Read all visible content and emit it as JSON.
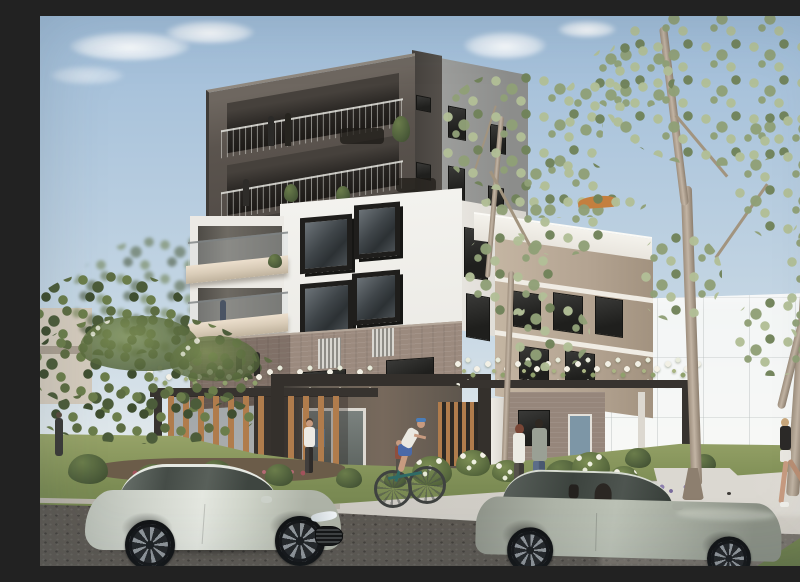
{
  "scene": {
    "type": "architectural-render",
    "description": "Daytime architectural render of a modern six-storey apartment building with a dark charcoal top volume containing two recessed balcony levels, a white mid-section with black box-framed windows, a taupe brick base with louvred screens, and a timber-and-steel entry pergola covered in white flowering vines; eucalyptus trees frame the scene, translucent white massing volumes indicate neighbouring future development, and the street in front has a parked silver sedan, a passing grey sedan, a cyclist, walkers and two joggers.",
    "sky": {
      "condition": "clear light-blue sky with small soft white clouds"
    },
    "building": {
      "storeys_visible": 6,
      "top_levels": "dark charcoal box, two recessed balcony levels with thin metal railings, residents and potted plants on balconies",
      "right_tower": "grey vertically-clad corner with small dark window slots",
      "middle_levels": "white facade, two rows of protruding black box-framed windows, beige balcony slabs with glass balustrades on the left",
      "lower_levels": "taupe face-brick band with vertical louvre screens and dark windows",
      "roof_terrace": "planted rooftop terrace with a rust-orange umbrella on the right wing",
      "ground_level": "charcoal base with timber batten screens, glazed lobby entry and brick wing"
    },
    "landscape": {
      "pergola": "dark steel portal frames with vertical timber battens and white climbing flowers",
      "gardens": "clipped round bushes, white rose beds, red and purple flower borders, lawn verge",
      "trees": "tall eucalyptus trees on the right and centre, dense leafy green and white-flowering trees on the left",
      "future_development": "translucent white gridded massing volumes behind the trees",
      "street": "dark asphalt road, light concrete footpath and driveway, grass nature strip"
    },
    "vehicles": [
      {
        "type": "sedan",
        "color": "silver",
        "state": "parked, facing right, foreground left"
      },
      {
        "type": "sedan",
        "color": "grey-green",
        "state": "moving right with driver visible, foreground right"
      }
    ],
    "people": [
      {
        "where": "upper balcony",
        "what": "two residents standing at the railing"
      },
      {
        "where": "lower balcony",
        "what": "resident among potted plants"
      },
      {
        "where": "mid-level balcony",
        "what": "resident at the balustrade"
      },
      {
        "where": "level-one balcony behind flowers",
        "what": "two residents"
      },
      {
        "where": "entry path",
        "what": "woman in white top walking"
      },
      {
        "where": "garden path",
        "what": "child in dark red top"
      },
      {
        "where": "street verge",
        "what": "cyclist in white tee, blue cap and blue shorts"
      },
      {
        "where": "footpath centre",
        "what": "couple strolling"
      },
      {
        "where": "footpath right",
        "what": "two women jogging past eucalyptus trunks"
      },
      {
        "where": "far-left garden",
        "what": "pedestrian in dark clothing"
      }
    ]
  },
  "colors": {
    "sky_top": "#9fbcd8",
    "sky_mid": "#c6d7e4",
    "sky_low": "#e4eaec",
    "charcoal": "#5b544e",
    "charcoal_dark": "#353029",
    "charcoal_deep": "#1d1a17",
    "grey_clad": "#9d9e9c",
    "white_wall": "#f3f2ee",
    "white_shade": "#dedbd4",
    "window_black": "#23221f",
    "glass_dark": "#3f4549",
    "glass_mid": "#6c7378",
    "balcony_beige": "#d9ccb8",
    "brick": "#9b8a7e",
    "tan_wing": "#c4b5a2",
    "timber": "#b07c4c",
    "steel_dark": "#37332f",
    "euc_light": "#b2bf97",
    "euc_mid": "#90a077",
    "euc_dark": "#71835a",
    "foliage_dark": "#4c5c3a",
    "foliage_mid": "#6b7d4b",
    "trunk_light": "#c2b4a4",
    "trunk_mid": "#9d8e7d",
    "grass_light": "#97a368",
    "grass_mid": "#7c8c54",
    "grass_dark": "#67784a",
    "soil": "#6b5c49",
    "road": "#5d5953",
    "path": "#d5d2cb",
    "driveway": "#dbd8d1",
    "curb": "#b7b2a8",
    "car_silver": "#d6dad2",
    "car_grey": "#aeb4a8",
    "flower_white": "#f2f0e5",
    "flower_red": "#a2525c",
    "flower_purple": "#8d7fae",
    "flower_lavender": "#a495c0",
    "skin": "#c79b80",
    "ghost": "rgba(250,250,248,0.86)",
    "umbrella": "#c47f3f",
    "denim": "#5c6d88",
    "bike_teal": "#2f6b66",
    "cap_blue": "#4a7db8",
    "shorts_blue": "#4a69a8",
    "shorts_red": "#c2664a"
  }
}
